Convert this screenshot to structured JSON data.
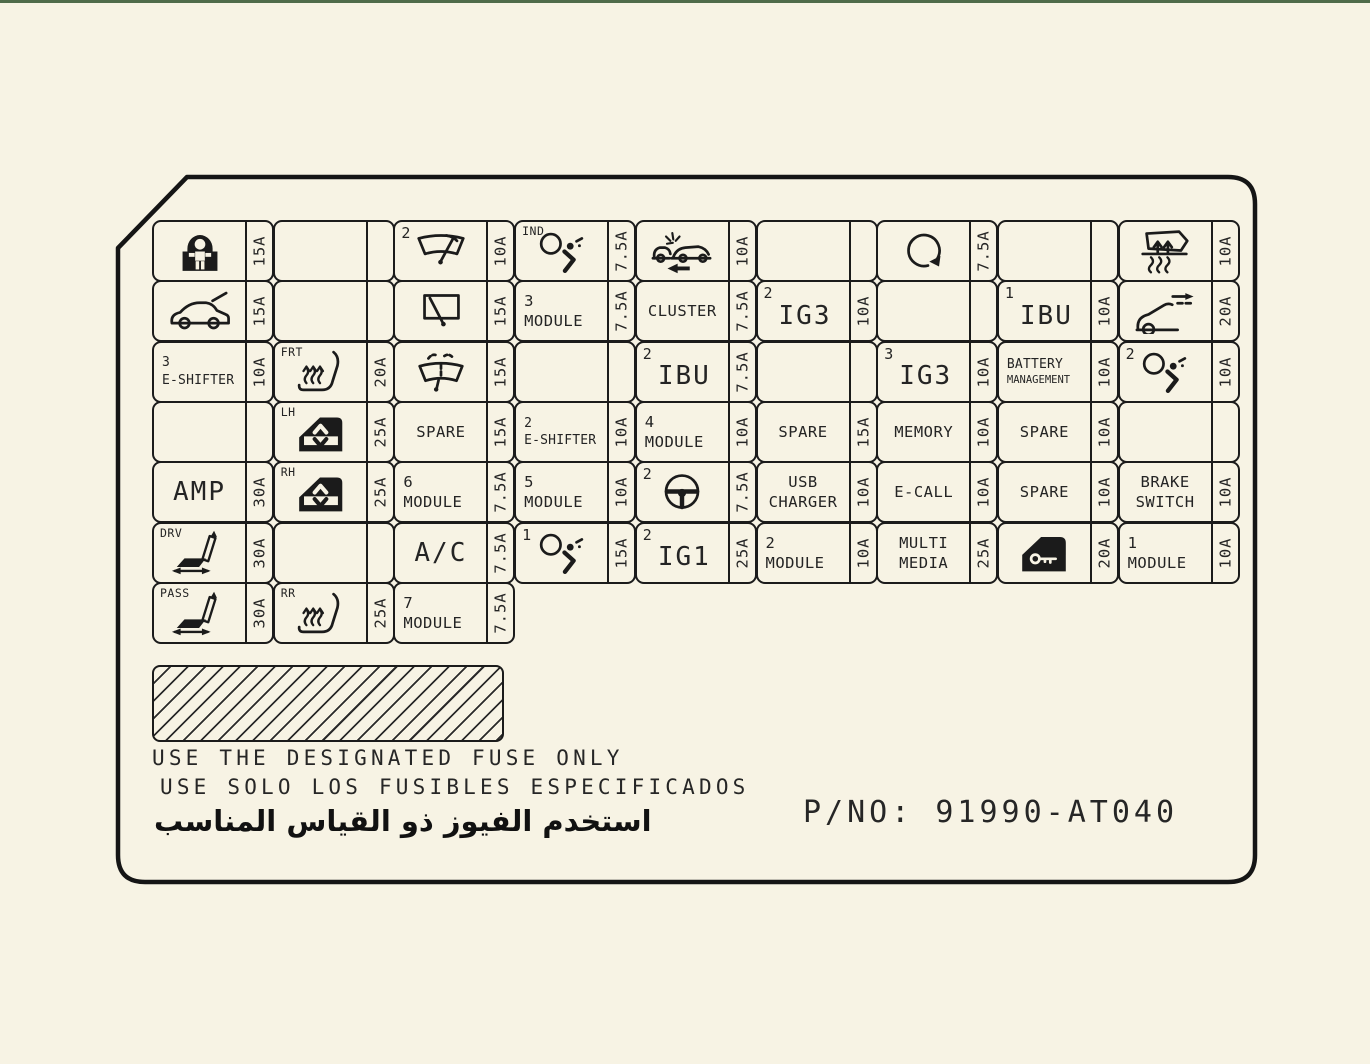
{
  "page": {
    "bg_color": "#f7f3e4",
    "line_color": "#1b1b1b",
    "top_edge_color": "#4f6b4a"
  },
  "footer": {
    "notice_en": "USE THE DESIGNATED FUSE ONLY",
    "notice_es": "USE SOLO LOS FUSIBLES ESPECIFICADOS",
    "notice_ar": "استخدم الفيوز ذو القياس المناسب",
    "part_no": "P/NO: 91990-AT040"
  },
  "grid": {
    "rows": [
      [
        {
          "name": "child-seat",
          "icon": "child-seat-icon",
          "amp": "15A"
        },
        {
          "name": "empty",
          "empty": true
        },
        {
          "name": "front-wiper",
          "prefix": "2",
          "icon": "front-wiper-icon",
          "amp": "10A"
        },
        {
          "name": "airbag-indicator",
          "prefix": "IND",
          "icon": "airbag-icon",
          "amp": "7.5A"
        },
        {
          "name": "collision",
          "icon": "crash-car-icon",
          "amp": "10A"
        },
        {
          "name": "empty",
          "empty": true
        },
        {
          "name": "heated-steering",
          "icon": "heated-steering-icon",
          "amp": "7.5A"
        },
        {
          "name": "empty",
          "empty": true
        },
        {
          "name": "heated-mirror",
          "icon": "heated-mirror-icon",
          "amp": "10A"
        }
      ],
      [
        {
          "name": "tailgate",
          "icon": "tailgate-icon",
          "amp": "15A"
        },
        {
          "name": "empty",
          "empty": true
        },
        {
          "name": "rear-wiper",
          "icon": "rear-wiper-icon",
          "amp": "15A"
        },
        {
          "name": "module-3",
          "lines": [
            "3",
            "MODULE"
          ],
          "size": "md",
          "align": "left",
          "amp": "7.5A"
        },
        {
          "name": "cluster",
          "lines": [
            "CLUSTER"
          ],
          "size": "md",
          "align": "center",
          "amp": "7.5A"
        },
        {
          "name": "ig3-2",
          "prefix": "2",
          "lines": [
            "IG3"
          ],
          "size": "lg",
          "align": "center",
          "amp": "10A"
        },
        {
          "name": "empty",
          "empty": true
        },
        {
          "name": "ibu-1",
          "prefix": "1",
          "lines": [
            "IBU"
          ],
          "size": "lg",
          "align": "center",
          "amp": "10A"
        },
        {
          "name": "power-trunk",
          "icon": "power-trunk-icon",
          "amp": "20A"
        }
      ],
      [
        {
          "name": "e-shifter-3",
          "lines": [
            "3",
            "E-SHIFTER"
          ],
          "size": "sm",
          "align": "left",
          "amp": "10A"
        },
        {
          "name": "heated-seat-front",
          "prefix": "FRT",
          "icon": "heated-seat-icon",
          "amp": "20A"
        },
        {
          "name": "washer",
          "icon": "washer-icon",
          "amp": "15A"
        },
        {
          "name": "empty",
          "empty": true
        },
        {
          "name": "ibu-2",
          "prefix": "2",
          "lines": [
            "IBU"
          ],
          "size": "lg",
          "align": "center",
          "amp": "7.5A"
        },
        {
          "name": "empty",
          "empty": true
        },
        {
          "name": "ig3-3",
          "prefix": "3",
          "lines": [
            "IG3"
          ],
          "size": "lg",
          "align": "center",
          "amp": "10A"
        },
        {
          "name": "battery-management",
          "lines": [
            "BATTERY",
            "MANAGEMENT"
          ],
          "size": "sm",
          "align": "left",
          "line2_small": true,
          "amp": "10A"
        },
        {
          "name": "airbag-2",
          "prefix": "2",
          "icon": "airbag-icon",
          "amp": "10A"
        }
      ],
      [
        {
          "name": "empty",
          "empty": true
        },
        {
          "name": "window-lh",
          "prefix": "LH",
          "icon": "window-icon",
          "amp": "25A"
        },
        {
          "name": "spare-1",
          "lines": [
            "SPARE"
          ],
          "size": "md",
          "align": "center",
          "amp": "15A"
        },
        {
          "name": "e-shifter-2",
          "lines": [
            "2",
            "E-SHIFTER"
          ],
          "size": "sm",
          "align": "left",
          "amp": "10A"
        },
        {
          "name": "module-4",
          "lines": [
            "4",
            "MODULE"
          ],
          "size": "md",
          "align": "left",
          "amp": "10A"
        },
        {
          "name": "spare-2",
          "lines": [
            "SPARE"
          ],
          "size": "md",
          "align": "center",
          "amp": "15A"
        },
        {
          "name": "memory",
          "lines": [
            "MEMORY"
          ],
          "size": "md",
          "align": "center",
          "amp": "10A"
        },
        {
          "name": "spare-3",
          "lines": [
            "SPARE"
          ],
          "size": "md",
          "align": "center",
          "amp": "10A"
        },
        {
          "name": "empty",
          "empty": true
        }
      ],
      [
        {
          "name": "amp",
          "lines": [
            "AMP"
          ],
          "size": "lg",
          "align": "center",
          "amp": "30A"
        },
        {
          "name": "window-rh",
          "prefix": "RH",
          "icon": "window-icon",
          "amp": "25A"
        },
        {
          "name": "module-6",
          "lines": [
            "6",
            "MODULE"
          ],
          "size": "md",
          "align": "left",
          "amp": "7.5A"
        },
        {
          "name": "module-5",
          "lines": [
            "5",
            "MODULE"
          ],
          "size": "md",
          "align": "left",
          "amp": "10A"
        },
        {
          "name": "heated-steering-2",
          "prefix": "2",
          "icon": "steering-wheel-icon",
          "amp": "7.5A"
        },
        {
          "name": "usb-charger",
          "lines": [
            "USB",
            "CHARGER"
          ],
          "size": "md",
          "align": "center",
          "amp": "10A"
        },
        {
          "name": "e-call",
          "lines": [
            "E-CALL"
          ],
          "size": "md",
          "align": "center",
          "amp": "10A"
        },
        {
          "name": "spare-4",
          "lines": [
            "SPARE"
          ],
          "size": "md",
          "align": "center",
          "amp": "10A"
        },
        {
          "name": "brake-switch",
          "lines": [
            "BRAKE",
            "SWITCH"
          ],
          "size": "md",
          "align": "center",
          "amp": "10A"
        }
      ],
      [
        {
          "name": "power-seat-driver",
          "prefix": "DRV",
          "icon": "power-seat-icon",
          "amp": "30A"
        },
        {
          "name": "empty",
          "empty": true
        },
        {
          "name": "ac",
          "lines": [
            "A/C"
          ],
          "size": "lg",
          "align": "center",
          "amp": "7.5A"
        },
        {
          "name": "airbag-1",
          "prefix": "1",
          "icon": "airbag-icon",
          "amp": "15A"
        },
        {
          "name": "ig1-2",
          "prefix": "2",
          "lines": [
            "IG1"
          ],
          "size": "lg",
          "align": "center",
          "amp": "25A"
        },
        {
          "name": "module-2",
          "lines": [
            "2",
            "MODULE"
          ],
          "size": "md",
          "align": "left",
          "amp": "10A"
        },
        {
          "name": "multimedia",
          "lines": [
            "MULTI",
            "MEDIA"
          ],
          "size": "md",
          "align": "center",
          "amp": "25A"
        },
        {
          "name": "door-lock",
          "icon": "door-key-icon",
          "amp": "20A"
        },
        {
          "name": "module-1",
          "lines": [
            "1",
            "MODULE"
          ],
          "size": "md",
          "align": "left",
          "amp": "10A"
        }
      ],
      [
        {
          "name": "power-seat-passenger",
          "prefix": "PASS",
          "icon": "power-seat-icon",
          "amp": "30A"
        },
        {
          "name": "heated-seat-rear",
          "prefix": "RR",
          "icon": "heated-seat-icon",
          "amp": "25A"
        },
        {
          "name": "module-7",
          "lines": [
            "7",
            "MODULE"
          ],
          "size": "md",
          "align": "left",
          "amp": "7.5A"
        }
      ]
    ]
  }
}
